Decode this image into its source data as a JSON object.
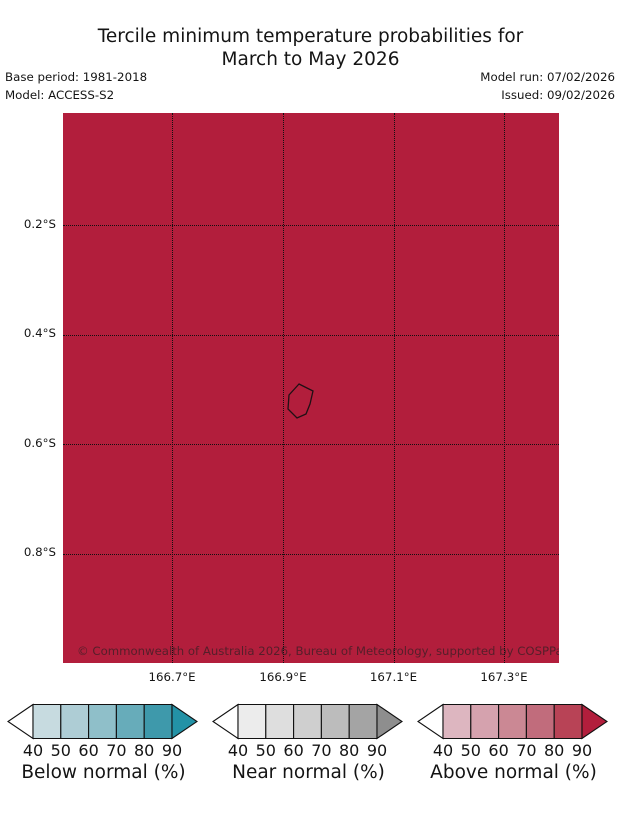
{
  "header": {
    "title_line1": "Tercile minimum temperature probabilities for",
    "title_line2": "March to May 2026",
    "base_period_label": "Base period: 1981-2018",
    "model_label": "Model: ACCESS-S2",
    "model_run_label": "Model run: 07/02/2026",
    "issued_label": "Issued: 09/02/2026"
  },
  "map": {
    "fill_color": "#b21e3c",
    "grid_color": "#101010",
    "coastline_color": "#1f1014",
    "copyright_text": "© Commonwealth of Australia 2026, Bureau of Meteorology, supported by COSPPac",
    "x_ticks": [
      {
        "label": "166.7°E",
        "pos": 0.2198
      },
      {
        "label": "166.9°E",
        "pos": 0.4435
      },
      {
        "label": "167.1°E",
        "pos": 0.6663
      },
      {
        "label": "167.3°E",
        "pos": 0.8891
      }
    ],
    "y_ticks": [
      {
        "label": "0.2°S",
        "pos": 0.2036
      },
      {
        "label": "0.4°S",
        "pos": 0.4027
      },
      {
        "label": "0.6°S",
        "pos": 0.6018
      },
      {
        "label": "0.8°S",
        "pos": 0.8009
      }
    ],
    "island_points": [
      [
        236,
        271
      ],
      [
        250,
        278
      ],
      [
        247,
        291
      ],
      [
        243,
        301
      ],
      [
        234,
        305
      ],
      [
        225,
        296
      ],
      [
        226,
        282
      ]
    ]
  },
  "colorbars": [
    {
      "label": "Below normal (%)",
      "ticks": [
        "40",
        "50",
        "60",
        "70",
        "80",
        "90"
      ],
      "segment_colors": [
        "#c7dbe0",
        "#aecdd5",
        "#8fbfc9",
        "#67acba",
        "#3e99ab"
      ],
      "over_arrow_color": "#2392a6",
      "under_arrow_color": "#ffffff"
    },
    {
      "label": "Near normal (%)",
      "ticks": [
        "40",
        "50",
        "60",
        "70",
        "80",
        "90"
      ],
      "segment_colors": [
        "#ececec",
        "#dedede",
        "#cfcfcf",
        "#bcbcbc",
        "#a4a4a4"
      ],
      "over_arrow_color": "#8e8e8e",
      "under_arrow_color": "#ffffff"
    },
    {
      "label": "Above normal (%)",
      "ticks": [
        "40",
        "50",
        "60",
        "70",
        "80",
        "90"
      ],
      "segment_colors": [
        "#ddb6c0",
        "#d5a2ae",
        "#cb8894",
        "#c16c7c",
        "#b84356"
      ],
      "over_arrow_color": "#b21e3c",
      "under_arrow_color": "#ffffff"
    }
  ],
  "chart_data": {
    "type": "heatmap",
    "title": "Tercile minimum temperature probabilities for March to May 2026",
    "subtitle_meta": {
      "base_period": "1981-2018",
      "model": "ACCESS-S2",
      "model_run": "07/02/2026",
      "issued": "09/02/2026"
    },
    "region": "Nauru",
    "x_axis": {
      "tick_labels": [
        "166.7°E",
        "166.9°E",
        "167.1°E",
        "167.3°E"
      ],
      "range_deg_east": [
        166.5,
        167.4
      ]
    },
    "y_axis": {
      "tick_labels": [
        "0.2°S",
        "0.4°S",
        "0.6°S",
        "0.8°S"
      ],
      "range_deg_south": [
        0.0,
        1.0
      ]
    },
    "grid": "dotted",
    "values_summary": "Entire map extent shaded in the 'Above normal' > 90% probability color (#b21e3c); one small island coastline outlined near 0.52°S, 166.93°E",
    "legend_position": "bottom",
    "legend": [
      {
        "title": "Below normal (%)",
        "bin_edges": [
          40,
          50,
          60,
          70,
          80,
          90
        ],
        "colors": [
          "#c7dbe0",
          "#aecdd5",
          "#8fbfc9",
          "#67acba",
          "#3e99ab"
        ],
        "over_color": "#2392a6"
      },
      {
        "title": "Near normal (%)",
        "bin_edges": [
          40,
          50,
          60,
          70,
          80,
          90
        ],
        "colors": [
          "#ececec",
          "#dedede",
          "#cfcfcf",
          "#bcbcbc",
          "#a4a4a4"
        ],
        "over_color": "#8e8e8e"
      },
      {
        "title": "Above normal (%)",
        "bin_edges": [
          40,
          50,
          60,
          70,
          80,
          90
        ],
        "colors": [
          "#ddb6c0",
          "#d5a2ae",
          "#cb8894",
          "#c16c7c",
          "#b84356"
        ],
        "over_color": "#b21e3c"
      }
    ]
  }
}
